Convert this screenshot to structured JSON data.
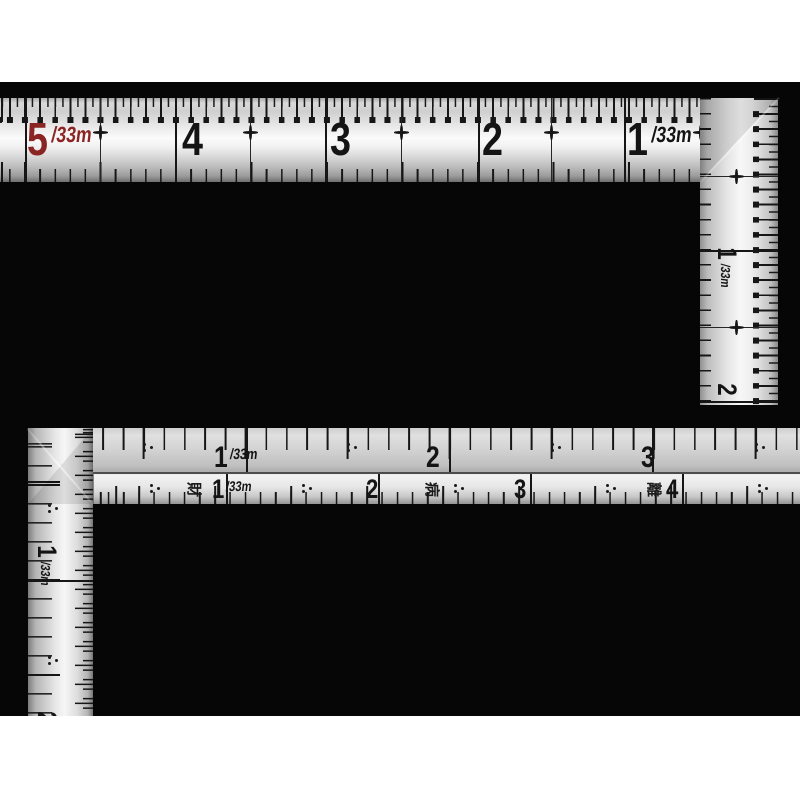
{
  "meta": {
    "description": "Product photo of two L-shaped carpenter squares (sashigane) with 1/33m shakkan graduations on a black background",
    "page_background": "#ffffff",
    "photo_background": "#060606"
  },
  "colors": {
    "ink": "#141414",
    "red_number": "#8b2523",
    "metal_highlight": "#fbfbfb",
    "metal_shadow": "#6e6e6e"
  },
  "top_square": {
    "horizontal_scale": {
      "numbers": [
        {
          "value": "5",
          "unit": "/33m",
          "x": 27,
          "color": "#8b2523"
        },
        {
          "value": "4",
          "x": 182
        },
        {
          "value": "3",
          "x": 330
        },
        {
          "value": "2",
          "x": 482
        },
        {
          "value": "1",
          "unit": "/33m",
          "x": 627
        }
      ],
      "major_lines_x": [
        25,
        175,
        325,
        478,
        624
      ],
      "half_lines_x": [
        100,
        250,
        401,
        551,
        700
      ]
    },
    "vertical_scale": {
      "labels": [
        {
          "value": "1",
          "unit": "/33m",
          "y": 140
        },
        {
          "value": "2",
          "y": 262
        }
      ],
      "major_lines_y": [
        152,
        303
      ],
      "half_lines_y": [
        78,
        229
      ]
    }
  },
  "bottom_square": {
    "upper_scale": {
      "numbers": [
        {
          "value": "1",
          "unit": "/33m",
          "x": 186
        },
        {
          "value": "2",
          "x": 398
        },
        {
          "value": "3",
          "x": 613
        }
      ],
      "major_lines_x": [
        218,
        421,
        624
      ],
      "half_dots_x": [
        115,
        319,
        523,
        727
      ]
    },
    "lower_scale": {
      "numbers": [
        {
          "value": "1",
          "unit": "/33m",
          "x": 184
        },
        {
          "value": "2",
          "x": 338
        },
        {
          "value": "3",
          "x": 486
        },
        {
          "value": "4",
          "x": 638
        }
      ],
      "kanji_marks": [
        {
          "char": "財",
          "x": 158
        },
        {
          "char": "病",
          "x": 396
        },
        {
          "char": "離",
          "x": 618
        }
      ],
      "major_lines_x": [
        198,
        350,
        502,
        654
      ],
      "half_dots_x": [
        122,
        274,
        426,
        578,
        730
      ]
    },
    "vertical_scale": {
      "labels": [
        {
          "value": "1",
          "unit": "/33m",
          "y": 108
        },
        {
          "value": "2",
          "y": 260
        }
      ],
      "major_lines_y": [
        152
      ],
      "half_dots_y": [
        76,
        228
      ]
    }
  }
}
